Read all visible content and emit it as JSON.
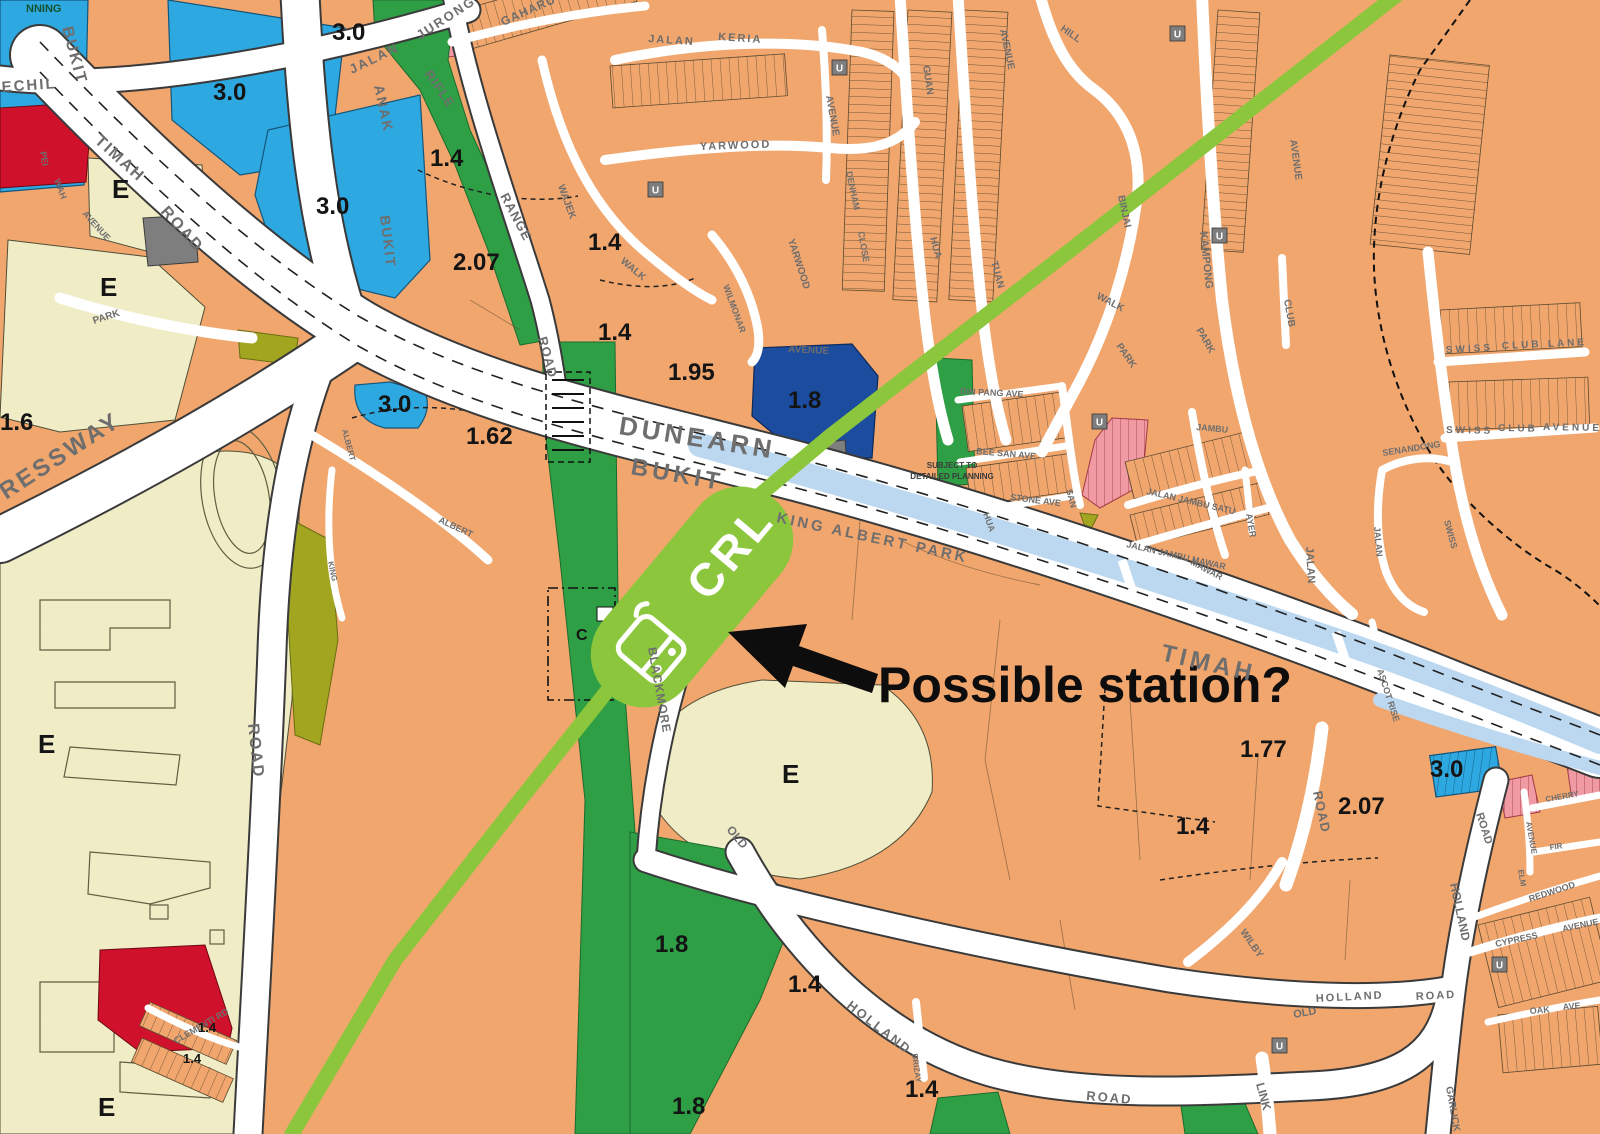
{
  "annotation": {
    "label": "Possible station?"
  },
  "station": {
    "label": "CRL",
    "icon": "train-front-icon"
  },
  "notes": {
    "line1": "SUBJECT TO",
    "line2": "DETAILED PLANNING"
  },
  "fragment": {
    "label": "NNING"
  },
  "colors": {
    "residential": "#F1A66E",
    "education": "#F0ECC6",
    "commercial_blue": "#2EA8E1",
    "dark_blue": "#1C4C9E",
    "red": "#D0112B",
    "pink": "#F09AA4",
    "park_green": "#2E9F45",
    "olive": "#A1A51F",
    "canal": "#BCD8F0",
    "gray": "#7E7E7E",
    "crl_green": "#8CC63C",
    "road": "#FFFFFF",
    "label_gray": "#6E6E6E"
  },
  "plot_ratios": [
    {
      "v": "3.0",
      "x": 332,
      "y": 40
    },
    {
      "v": "3.0",
      "x": 213,
      "y": 100
    },
    {
      "v": "3.0",
      "x": 316,
      "y": 214
    },
    {
      "v": "1.6",
      "x": 0,
      "y": 430
    },
    {
      "v": "3.0",
      "x": 378,
      "y": 412
    },
    {
      "v": "1.62",
      "x": 466,
      "y": 444
    },
    {
      "v": "1.4",
      "x": 430,
      "y": 166
    },
    {
      "v": "2.07",
      "x": 453,
      "y": 270
    },
    {
      "v": "1.4",
      "x": 588,
      "y": 250
    },
    {
      "v": "1.4",
      "x": 598,
      "y": 340
    },
    {
      "v": "1.95",
      "x": 668,
      "y": 380
    },
    {
      "v": "1.8",
      "x": 788,
      "y": 408,
      "c": "#ffffff"
    },
    {
      "v": "1.77",
      "x": 1240,
      "y": 757
    },
    {
      "v": "1.4",
      "x": 1176,
      "y": 834
    },
    {
      "v": "2.07",
      "x": 1338,
      "y": 814
    },
    {
      "v": "3.0",
      "x": 1430,
      "y": 777
    },
    {
      "v": "1.8",
      "x": 655,
      "y": 952
    },
    {
      "v": "1.4",
      "x": 788,
      "y": 992
    },
    {
      "v": "1.8",
      "x": 672,
      "y": 1114
    },
    {
      "v": "1.4",
      "x": 905,
      "y": 1097
    },
    {
      "v": "1.4",
      "x": 198,
      "y": 1032,
      "s": 13
    },
    {
      "v": "1.4",
      "x": 183,
      "y": 1063,
      "s": 13
    }
  ],
  "zone_letters": [
    {
      "t": "E",
      "x": 112,
      "y": 198
    },
    {
      "t": "E",
      "x": 100,
      "y": 296
    },
    {
      "t": "E",
      "x": 38,
      "y": 753
    },
    {
      "t": "E",
      "x": 98,
      "y": 1116
    },
    {
      "t": "E",
      "x": 782,
      "y": 783
    },
    {
      "t": "C",
      "x": 576,
      "y": 640,
      "s": 16
    }
  ],
  "u_markers": {
    "label": "U",
    "points": [
      {
        "x": 648,
        "y": 182
      },
      {
        "x": 832,
        "y": 60
      },
      {
        "x": 1170,
        "y": 26
      },
      {
        "x": 1212,
        "y": 228
      },
      {
        "x": 1092,
        "y": 414
      },
      {
        "x": 1492,
        "y": 957
      },
      {
        "x": 1272,
        "y": 1038
      }
    ]
  },
  "road_labels": [
    {
      "t": "BUKIT",
      "x": 62,
      "y": 28,
      "r": 75,
      "s": 16,
      "ls": 2
    },
    {
      "t": "TIMAH",
      "x": 94,
      "y": 142,
      "r": 42,
      "s": 16,
      "ls": 2
    },
    {
      "t": "ROAD",
      "x": 160,
      "y": 212,
      "r": 48,
      "s": 16,
      "ls": 2
    },
    {
      "t": "ECHIL",
      "x": 2,
      "y": 92,
      "r": -4,
      "s": 15,
      "ls": 2
    },
    {
      "t": "JALAN",
      "x": 352,
      "y": 74,
      "r": -26,
      "s": 13,
      "ls": 2
    },
    {
      "t": "JURONG",
      "x": 420,
      "y": 40,
      "r": -33,
      "s": 13,
      "ls": 2
    },
    {
      "t": "ANAK",
      "x": 374,
      "y": 86,
      "r": 78,
      "s": 14,
      "ls": 2
    },
    {
      "t": "BUKIT",
      "x": 380,
      "y": 216,
      "r": 83,
      "s": 14,
      "ls": 2
    },
    {
      "t": "PEI",
      "x": 40,
      "y": 152,
      "r": 80,
      "s": 9
    },
    {
      "t": "WAH",
      "x": 54,
      "y": 180,
      "r": 70,
      "s": 9
    },
    {
      "t": "AVENUE",
      "x": 82,
      "y": 214,
      "r": 48,
      "s": 9
    },
    {
      "t": "PARK",
      "x": 94,
      "y": 324,
      "r": -18,
      "s": 10
    },
    {
      "t": "RESSWAY",
      "x": 6,
      "y": 500,
      "r": -33,
      "s": 24,
      "ls": 3,
      "c": "#4d4d4d"
    },
    {
      "t": "ROAD",
      "x": 248,
      "y": 724,
      "r": 84,
      "s": 16,
      "ls": 2
    },
    {
      "t": "CLEMENTI RD",
      "x": 176,
      "y": 1044,
      "r": -30,
      "s": 9
    },
    {
      "t": "RIFLE",
      "x": 424,
      "y": 74,
      "r": 55,
      "s": 13,
      "ls": 1
    },
    {
      "t": "RANGE",
      "x": 500,
      "y": 196,
      "r": 62,
      "s": 13,
      "ls": 1
    },
    {
      "t": "ROAD",
      "x": 538,
      "y": 338,
      "r": 75,
      "s": 13,
      "ls": 1
    },
    {
      "t": "GAHARU",
      "x": 503,
      "y": 26,
      "r": -24,
      "s": 12,
      "ls": 1
    },
    {
      "t": "JALAN",
      "x": 648,
      "y": 42,
      "r": 4,
      "s": 11,
      "ls": 2
    },
    {
      "t": "KERIA",
      "x": 718,
      "y": 40,
      "r": 4,
      "s": 11,
      "ls": 2
    },
    {
      "t": "YARWOOD",
      "x": 700,
      "y": 150,
      "r": -2,
      "s": 11,
      "ls": 2
    },
    {
      "t": "WAJEK",
      "x": 558,
      "y": 186,
      "r": 70,
      "s": 10
    },
    {
      "t": "WALK",
      "x": 620,
      "y": 262,
      "r": 40,
      "s": 10
    },
    {
      "t": "WILMONAR",
      "x": 723,
      "y": 286,
      "r": 70,
      "s": 9
    },
    {
      "t": "AVENUE",
      "x": 788,
      "y": 352,
      "r": 3,
      "s": 10
    },
    {
      "t": "AVENUE",
      "x": 826,
      "y": 96,
      "r": 80,
      "s": 10
    },
    {
      "t": "YARWOOD",
      "x": 788,
      "y": 240,
      "r": 72,
      "s": 10
    },
    {
      "t": "DENHAM",
      "x": 846,
      "y": 172,
      "r": 78,
      "s": 9
    },
    {
      "t": "CLOSE",
      "x": 858,
      "y": 232,
      "r": 80,
      "s": 9
    },
    {
      "t": "HILL",
      "x": 1060,
      "y": 30,
      "r": 35,
      "s": 10
    },
    {
      "t": "GUAN",
      "x": 923,
      "y": 66,
      "r": 82,
      "s": 10
    },
    {
      "t": "HUA",
      "x": 930,
      "y": 238,
      "r": 75,
      "s": 10
    },
    {
      "t": "AVENUE",
      "x": 1000,
      "y": 30,
      "r": 78,
      "s": 10
    },
    {
      "t": "TUAN",
      "x": 991,
      "y": 262,
      "r": 75,
      "s": 10
    },
    {
      "t": "BINJAI",
      "x": 1118,
      "y": 196,
      "r": 78,
      "s": 10
    },
    {
      "t": "WALK",
      "x": 1096,
      "y": 298,
      "r": 28,
      "s": 10
    },
    {
      "t": "PARK",
      "x": 1116,
      "y": 346,
      "r": 55,
      "s": 10
    },
    {
      "t": "PARK",
      "x": 1196,
      "y": 330,
      "r": 60,
      "s": 10
    },
    {
      "t": "KAMPONG",
      "x": 1200,
      "y": 232,
      "r": 84,
      "s": 11
    },
    {
      "t": "CLUB",
      "x": 1284,
      "y": 300,
      "r": 80,
      "s": 10
    },
    {
      "t": "AVENUE",
      "x": 1290,
      "y": 140,
      "r": 82,
      "s": 10
    },
    {
      "t": "SWISS",
      "x": 1446,
      "y": 353,
      "r": -3,
      "s": 10,
      "ls": 3
    },
    {
      "t": "CLUB",
      "x": 1502,
      "y": 349,
      "r": -3,
      "s": 10,
      "ls": 3
    },
    {
      "t": "LANE",
      "x": 1548,
      "y": 347,
      "r": -3,
      "s": 10,
      "ls": 3
    },
    {
      "t": "SWISS",
      "x": 1446,
      "y": 433,
      "r": 1,
      "s": 10,
      "ls": 3
    },
    {
      "t": "CLUB",
      "x": 1498,
      "y": 431,
      "r": 1,
      "s": 10,
      "ls": 3
    },
    {
      "t": "AVENUE",
      "x": 1543,
      "y": 430,
      "r": 1,
      "s": 10,
      "ls": 3
    },
    {
      "t": "SENANDONG",
      "x": 1383,
      "y": 456,
      "r": -9,
      "s": 9
    },
    {
      "t": "JALAN",
      "x": 1374,
      "y": 527,
      "r": 85,
      "s": 9
    },
    {
      "t": "SWISS",
      "x": 1444,
      "y": 521,
      "r": 75,
      "s": 9
    },
    {
      "t": "JALAN",
      "x": 1306,
      "y": 547,
      "r": 87,
      "s": 11
    },
    {
      "t": "DUNEARN",
      "x": 618,
      "y": 434,
      "r": 9,
      "s": 26,
      "ls": 4,
      "c": "#4d4d4d"
    },
    {
      "t": "BUKIT",
      "x": 630,
      "y": 474,
      "r": 10,
      "s": 24,
      "ls": 4,
      "c": "#4d4d4d"
    },
    {
      "t": "KING ALBERT PARK",
      "x": 776,
      "y": 522,
      "r": 12,
      "s": 15,
      "ls": 3,
      "c": "#4d4d4d"
    },
    {
      "t": "TIMAH",
      "x": 1160,
      "y": 660,
      "r": 13,
      "s": 24,
      "ls": 4,
      "c": "#4d4d4d"
    },
    {
      "t": "DIN PANG AVE",
      "x": 960,
      "y": 394,
      "r": 3,
      "s": 9
    },
    {
      "t": "BEE SAN AVE",
      "x": 976,
      "y": 454,
      "r": 5,
      "s": 9
    },
    {
      "t": "STONE AVE",
      "x": 1010,
      "y": 500,
      "r": 7,
      "s": 9
    },
    {
      "t": "HUA",
      "x": 983,
      "y": 514,
      "r": 70,
      "s": 9
    },
    {
      "t": "SAN",
      "x": 1066,
      "y": 490,
      "r": 75,
      "s": 9
    },
    {
      "t": "JAMBU",
      "x": 1196,
      "y": 430,
      "r": 5,
      "s": 9
    },
    {
      "t": "JALAN JAMBU SATU",
      "x": 1146,
      "y": 494,
      "r": 13,
      "s": 9
    },
    {
      "t": "AYER",
      "x": 1246,
      "y": 514,
      "r": 80,
      "s": 9
    },
    {
      "t": "JALAN JAMBU MAWAR",
      "x": 1126,
      "y": 547,
      "r": 13,
      "s": 9
    },
    {
      "t": "MAWAR",
      "x": 1190,
      "y": 564,
      "r": 28,
      "s": 9
    },
    {
      "t": "ASCOT RISE",
      "x": 1377,
      "y": 670,
      "r": 72,
      "s": 9
    },
    {
      "t": "ROAD",
      "x": 1313,
      "y": 792,
      "r": 78,
      "s": 13,
      "ls": 1
    },
    {
      "t": "BLACKMORE",
      "x": 648,
      "y": 648,
      "r": 80,
      "s": 12,
      "ls": 1
    },
    {
      "t": "OLD",
      "x": 726,
      "y": 830,
      "r": 50,
      "s": 12
    },
    {
      "t": "HOLLAND",
      "x": 846,
      "y": 1007,
      "r": 38,
      "s": 13,
      "ls": 2
    },
    {
      "t": "ROAD",
      "x": 1086,
      "y": 1100,
      "r": 5,
      "s": 13,
      "ls": 2
    },
    {
      "t": "OLD",
      "x": 1294,
      "y": 1018,
      "r": -10,
      "s": 11
    },
    {
      "t": "HOLLAND",
      "x": 1316,
      "y": 1002,
      "r": -3,
      "s": 11,
      "ls": 2
    },
    {
      "t": "ROAD",
      "x": 1416,
      "y": 1000,
      "r": -3,
      "s": 11,
      "ls": 2
    },
    {
      "t": "LINK",
      "x": 1256,
      "y": 1084,
      "r": 75,
      "s": 12
    },
    {
      "t": "HOLLAND",
      "x": 1450,
      "y": 884,
      "r": 78,
      "s": 12
    },
    {
      "t": "ROAD",
      "x": 1476,
      "y": 814,
      "r": 72,
      "s": 11
    },
    {
      "t": "WILBY",
      "x": 1240,
      "y": 932,
      "r": 55,
      "s": 10
    },
    {
      "t": "CYPRESS",
      "x": 1496,
      "y": 947,
      "r": -12,
      "s": 9
    },
    {
      "t": "AVENUE",
      "x": 1563,
      "y": 932,
      "r": -12,
      "s": 9
    },
    {
      "t": "REDWOOD",
      "x": 1530,
      "y": 902,
      "r": -18,
      "s": 9
    },
    {
      "t": "OAK",
      "x": 1530,
      "y": 1014,
      "r": -5,
      "s": 9
    },
    {
      "t": "AVE",
      "x": 1563,
      "y": 1010,
      "r": -5,
      "s": 9
    },
    {
      "t": "ELM",
      "x": 1518,
      "y": 870,
      "r": 80,
      "s": 8
    },
    {
      "t": "AVENUE",
      "x": 1526,
      "y": 822,
      "r": 80,
      "s": 8
    },
    {
      "t": "CHERRY",
      "x": 1546,
      "y": 802,
      "r": -10,
      "s": 8
    },
    {
      "t": "FIR",
      "x": 1550,
      "y": 850,
      "r": -8,
      "s": 8
    },
    {
      "t": "GARLICK",
      "x": 1446,
      "y": 1087,
      "r": 80,
      "s": 10
    },
    {
      "t": "BRIZAY",
      "x": 912,
      "y": 1054,
      "r": 82,
      "s": 8
    },
    {
      "t": "KING",
      "x": 328,
      "y": 562,
      "r": 78,
      "s": 8
    },
    {
      "t": "ALBERT",
      "x": 342,
      "y": 430,
      "r": 75,
      "s": 8
    },
    {
      "t": "ALBERT",
      "x": 438,
      "y": 522,
      "r": 25,
      "s": 9
    }
  ]
}
